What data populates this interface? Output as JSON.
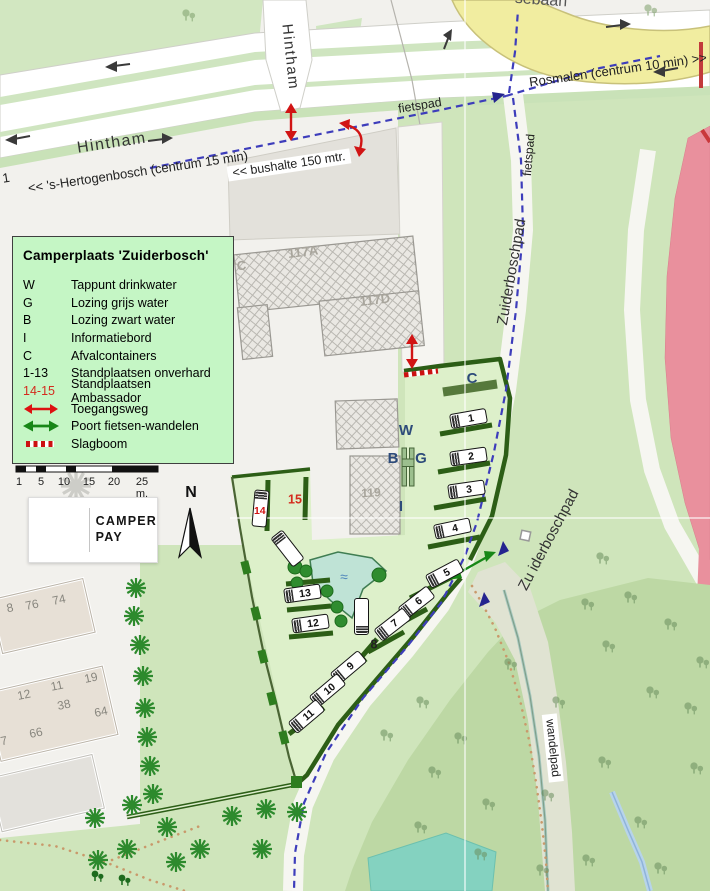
{
  "colors": {
    "legend_bg": "#c5f6c5",
    "map_red": "#d11414",
    "map_green_arrow": "#178717",
    "fence_green": "#2c5e16",
    "field_green": "#ddf0ca",
    "forest_green": "#bdd8a4",
    "yellow_road": "#f1eda0",
    "pink_zone": "#e9909d",
    "water_teal": "#84d2c0",
    "fietspad_blue": "#3d3dbb",
    "facility_blue": "#2d4b7a"
  },
  "north_label": "N",
  "logo": {
    "line1": "CAMPER",
    "line2": "PAY"
  },
  "legend": {
    "title": "Camperplaats  'Zuiderbosch'",
    "items": [
      {
        "key": "W",
        "label": "Tappunt drinkwater"
      },
      {
        "key": "G",
        "label": "Lozing grijs water"
      },
      {
        "key": "B",
        "label": "Lozing zwart water"
      },
      {
        "key": "I",
        "label": "Informatiebord"
      },
      {
        "key": "C",
        "label": "Afvalcontainers"
      },
      {
        "key": "1-13",
        "label": "Standplaatsen onverhard"
      },
      {
        "key": "14-15",
        "label": "Standplaatsen Ambassador",
        "key_color": "#d42b1d"
      },
      {
        "icon": "red-double-arrow",
        "label": "Toegangsweg"
      },
      {
        "icon": "green-double-arrow",
        "label": "Poort fietsen-wandelen"
      },
      {
        "icon": "slagboom",
        "label": "Slagboom"
      }
    ]
  },
  "scale_bar": {
    "labels": [
      "1",
      "5",
      "10",
      "15",
      "20",
      "25 m."
    ],
    "x": [
      19,
      41,
      64,
      89,
      114,
      142
    ]
  },
  "map": {
    "labels": [
      {
        "id": "road-label-hintham-main",
        "t": "Hintham",
        "x": 112,
        "y": 144,
        "r": -8.5,
        "s": 16,
        "c": "#333",
        "ls": 1.5
      },
      {
        "id": "road-label-hintham-vertical",
        "t": "Hintham",
        "x": 290,
        "y": 57,
        "r": 84,
        "s": 15,
        "c": "#333",
        "ls": 1.5
      },
      {
        "id": "road-label-sebaan-partial",
        "t": "sebaan",
        "x": 541,
        "y": 1,
        "r": 4,
        "s": 16,
        "c": "#555"
      },
      {
        "id": "road-label-rosmalen",
        "t": "Rosmalen (centrum 10 min)  >>",
        "x": 618,
        "y": 70,
        "r": -8,
        "s": 13,
        "c": "#222"
      },
      {
        "id": "road-label-number-1",
        "t": "1",
        "x": 6,
        "y": 178,
        "r": -9,
        "s": 13,
        "c": "#222"
      },
      {
        "id": "road-label-shertogenbosch",
        "t": "<<  's-Hertogenbosch (centrum 15 min)",
        "x": 138,
        "y": 172,
        "r": -8.5,
        "s": 13,
        "c": "#222"
      },
      {
        "id": "road-label-bushalte",
        "t": "<< bushalte 150 mtr.",
        "x": 289,
        "y": 165,
        "r": -8.5,
        "s": 12.5,
        "c": "#222",
        "bg": "#fff"
      },
      {
        "id": "path-label-fietspad-top",
        "t": "fietspad",
        "x": 420,
        "y": 106,
        "r": -9,
        "s": 12.5,
        "c": "#222"
      },
      {
        "id": "path-label-fietspad-vertical",
        "t": "fietspad",
        "x": 529,
        "y": 155,
        "r": -85,
        "s": 12,
        "c": "#222"
      },
      {
        "id": "path-label-zuiderboschpad-upper",
        "t": "Zuiderboschpad",
        "x": 512,
        "y": 272,
        "r": -80,
        "s": 15,
        "c": "#333"
      },
      {
        "id": "path-label-zuiderboschpad-lower",
        "t": "Zu iderboschpad",
        "x": 549,
        "y": 540,
        "r": -62,
        "s": 15,
        "c": "#333"
      },
      {
        "id": "path-label-wandelpad",
        "t": "wandelpad",
        "x": 553,
        "y": 748,
        "r": 84,
        "s": 12,
        "c": "#222",
        "bg": "#fff"
      },
      {
        "id": "facility-label-c-containers",
        "t": "C",
        "x": 472,
        "y": 379,
        "s": 15,
        "c": "#2d4b7a",
        "b": 1
      },
      {
        "id": "facility-label-w-drinkwater",
        "t": "W",
        "x": 406,
        "y": 431,
        "s": 15,
        "c": "#2d4b7a",
        "b": 1
      },
      {
        "id": "facility-label-b-zwartwater",
        "t": "B",
        "x": 393,
        "y": 459,
        "s": 15,
        "c": "#2d4b7a",
        "b": 1
      },
      {
        "id": "facility-label-g-grijswater",
        "t": "G",
        "x": 421,
        "y": 459,
        "s": 15,
        "c": "#2d4b7a",
        "b": 1
      },
      {
        "id": "facility-label-i-infobord",
        "t": "I",
        "x": 401,
        "y": 507,
        "s": 15,
        "c": "#2d4b7a",
        "b": 1
      },
      {
        "id": "spot-label-15",
        "t": "15",
        "x": 295,
        "y": 500,
        "s": 12.5,
        "c": "#d42b1d",
        "b": 1
      },
      {
        "id": "spot-label-8",
        "t": "8",
        "x": 374,
        "y": 645,
        "s": 12.5,
        "c": "#222",
        "b": 1
      },
      {
        "id": "pond-waves",
        "t": "≈",
        "x": 344,
        "y": 577,
        "s": 14,
        "c": "#4f86bb"
      },
      {
        "id": "building-label-117a",
        "t": "117A",
        "x": 303,
        "y": 252,
        "r": -7,
        "s": 13,
        "c": "#a8a59c",
        "b": 1
      },
      {
        "id": "building-label-117c",
        "t": "'C",
        "x": 240,
        "y": 266,
        "r": -7,
        "s": 13,
        "c": "#a8a59c",
        "b": 1
      },
      {
        "id": "building-label-117d",
        "t": "117D",
        "x": 375,
        "y": 300,
        "r": -7,
        "s": 13,
        "c": "#a8a59c",
        "b": 1
      },
      {
        "id": "building-label-119",
        "t": "119",
        "x": 371,
        "y": 493,
        "r": -3,
        "s": 12,
        "c": "#a8a59c",
        "b": 1
      },
      {
        "id": "house-number-8",
        "t": "8",
        "x": 10,
        "y": 608,
        "r": -12,
        "s": 12,
        "c": "#88867e"
      },
      {
        "id": "house-number-76",
        "t": "76",
        "x": 32,
        "y": 605,
        "r": -12,
        "s": 12,
        "c": "#88867e"
      },
      {
        "id": "house-number-74",
        "t": "74",
        "x": 59,
        "y": 600,
        "r": -12,
        "s": 12,
        "c": "#88867e"
      },
      {
        "id": "house-number-12",
        "t": "12",
        "x": 24,
        "y": 695,
        "r": -12,
        "s": 12,
        "c": "#88867e"
      },
      {
        "id": "house-number-11",
        "t": "11",
        "x": 57,
        "y": 686,
        "r": -12,
        "s": 12,
        "c": "#88867e"
      },
      {
        "id": "house-number-19",
        "t": "19",
        "x": 91,
        "y": 678,
        "r": -12,
        "s": 12,
        "c": "#88867e"
      },
      {
        "id": "house-number-38",
        "t": "38",
        "x": 64,
        "y": 705,
        "r": -12,
        "s": 12,
        "c": "#88867e"
      },
      {
        "id": "house-number-64",
        "t": "64",
        "x": 101,
        "y": 712,
        "r": -12,
        "s": 12,
        "c": "#88867e"
      },
      {
        "id": "house-number-66",
        "t": "66",
        "x": 36,
        "y": 733,
        "r": -12,
        "s": 12,
        "c": "#88867e"
      },
      {
        "id": "house-number-7",
        "t": "7",
        "x": 4,
        "y": 741,
        "r": -12,
        "s": 12,
        "c": "#88867e"
      }
    ],
    "spots": [
      {
        "n": "1",
        "x": 468,
        "y": 418,
        "rot": -10
      },
      {
        "n": "2",
        "x": 468,
        "y": 456,
        "rot": -8
      },
      {
        "n": "3",
        "x": 466,
        "y": 489,
        "rot": -8
      },
      {
        "n": "4",
        "x": 452,
        "y": 528,
        "rot": -12
      },
      {
        "n": "5",
        "x": 444,
        "y": 573,
        "rot": -28
      },
      {
        "n": "6",
        "x": 416,
        "y": 602,
        "rot": -38
      },
      {
        "n": "7",
        "x": 392,
        "y": 624,
        "rot": -38
      },
      {
        "n": "9",
        "x": 348,
        "y": 667,
        "rot": -40
      },
      {
        "n": "10",
        "x": 327,
        "y": 690,
        "rot": -40
      },
      {
        "n": "11",
        "x": 306,
        "y": 716,
        "rot": -40
      },
      {
        "n": "12",
        "x": 310,
        "y": 623,
        "rot": -8
      },
      {
        "n": "13",
        "x": 302,
        "y": 593,
        "rot": -8
      },
      {
        "n": "14",
        "x": 260,
        "y": 508,
        "rot": 95,
        "nrot": -95,
        "red": true
      },
      {
        "n": "",
        "x": 287,
        "y": 548,
        "rot": 52
      },
      {
        "n": "",
        "x": 361,
        "y": 616,
        "rot": -90
      }
    ],
    "vegetation": {
      "trees": [
        [
          136,
          588
        ],
        [
          134,
          616
        ],
        [
          140,
          645
        ],
        [
          143,
          676
        ],
        [
          145,
          708
        ],
        [
          147,
          737
        ],
        [
          150,
          766
        ],
        [
          153,
          794
        ],
        [
          95,
          818
        ],
        [
          132,
          805
        ],
        [
          167,
          827
        ],
        [
          127,
          849
        ],
        [
          98,
          860
        ],
        [
          176,
          862
        ],
        [
          200,
          849
        ],
        [
          232,
          816
        ],
        [
          266,
          809
        ],
        [
          297,
          812
        ],
        [
          262,
          849
        ]
      ],
      "tree_circles": [
        [
          295,
          567,
          7
        ],
        [
          306,
          571,
          6
        ],
        [
          297,
          583,
          6
        ],
        [
          327,
          591,
          6
        ],
        [
          337,
          607,
          6
        ],
        [
          341,
          621,
          6
        ],
        [
          379,
          575,
          7
        ]
      ],
      "forest_glyphs": [
        [
          420,
          700
        ],
        [
          458,
          736
        ],
        [
          508,
          662
        ],
        [
          556,
          700
        ],
        [
          606,
          644
        ],
        [
          650,
          690
        ],
        [
          602,
          760
        ],
        [
          545,
          793
        ],
        [
          638,
          820
        ],
        [
          486,
          802
        ],
        [
          432,
          770
        ],
        [
          384,
          733
        ],
        [
          688,
          706
        ],
        [
          694,
          766
        ],
        [
          658,
          866
        ],
        [
          586,
          858
        ],
        [
          478,
          852
        ],
        [
          418,
          825
        ],
        [
          600,
          556
        ],
        [
          585,
          602
        ],
        [
          628,
          595
        ],
        [
          668,
          622
        ],
        [
          700,
          660
        ],
        [
          540,
          868
        ]
      ],
      "field_glyphs": [
        [
          186,
          13
        ],
        [
          648,
          8
        ]
      ],
      "bush_glyphs": [
        [
          95,
          874
        ],
        [
          122,
          878
        ]
      ],
      "faded_tree": [
        76,
        486
      ]
    }
  }
}
